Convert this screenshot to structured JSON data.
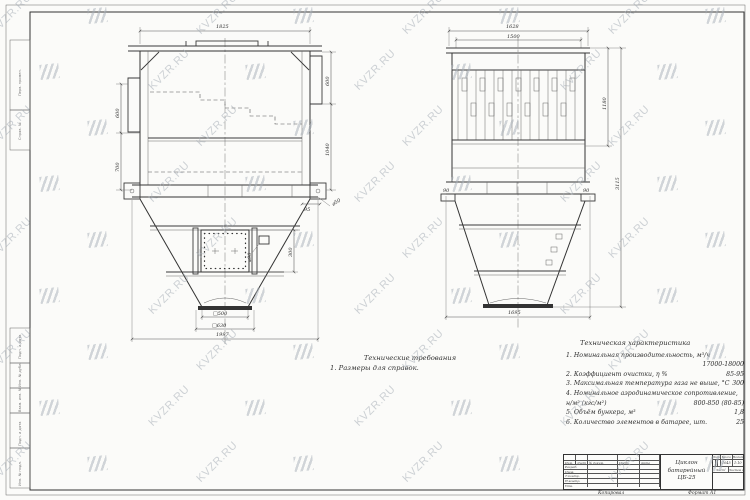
{
  "watermark": {
    "text": "KVZR.RU"
  },
  "tech_requirements": {
    "title": "Технические требования",
    "item1": "1. Размеры для справок."
  },
  "tech_characteristics": {
    "title": "Техническая характеристика",
    "items": [
      {
        "label": "1. Номинальная производительность, м³/ч",
        "value": "17000-18000"
      },
      {
        "label": "2. Коэффициент очистки, η %",
        "value": "85-95"
      },
      {
        "label": "3. Максимальная температура газа не выше, °С",
        "value": "300"
      },
      {
        "label": "4. Номинальное аэродинамическое сопротивление, н/м² (кгс/м²)",
        "value": "800-850 (80-85)"
      },
      {
        "label": "5. Объём бункера, м³",
        "value": "1,8"
      },
      {
        "label": "6. Количество элементов в батарее, шт.",
        "value": "25"
      }
    ]
  },
  "dims": {
    "lv_top": "1825",
    "lv_left_upper": "600",
    "lv_left_lower": "700",
    "lv_right_upper": "600",
    "lv_right_lower": "1040",
    "lv_door_height": "300",
    "lv_handle": "⌀90",
    "lv_offset": "95",
    "lv_pipe": "⌀50",
    "lv_sq_inner": "□500",
    "lv_sq_outer": "□630",
    "lv_overall_width": "1997",
    "rv_top": "1628",
    "rv_top_inner": "1500",
    "rv_corner_left": "90",
    "rv_corner_right": "90",
    "rv_upper_height": "1180",
    "rv_total_height": "3115",
    "rv_bottom": "1695"
  },
  "title_block": {
    "doc_line1": "Циклон",
    "doc_line2": "батарейный",
    "doc_line3": "ЦБ-25",
    "cols": [
      "Изм.",
      "Лист",
      "№ докум.",
      "Подп.",
      "Дата"
    ],
    "rows": [
      "Разраб.",
      "Пров.",
      "Т.контр.",
      "Н.контр.",
      "Утв."
    ],
    "lit_label": "Лит.",
    "mass_label": "Масса",
    "scale_label": "Масштаб",
    "mass_value": "1045",
    "scale_value": "1:10",
    "sheet_label": "Лист",
    "sheets_label": "Листов 1",
    "copied_label": "Копировал",
    "format_label": "Формат А1"
  },
  "margin_labels": {
    "top": [
      "Перв. примен.",
      "Справ. №"
    ],
    "bottom": [
      "Подп. и дата",
      "Инв. № дубл.",
      "Взам. инв. №",
      "Подп. и дата",
      "Инв. № подл."
    ]
  }
}
